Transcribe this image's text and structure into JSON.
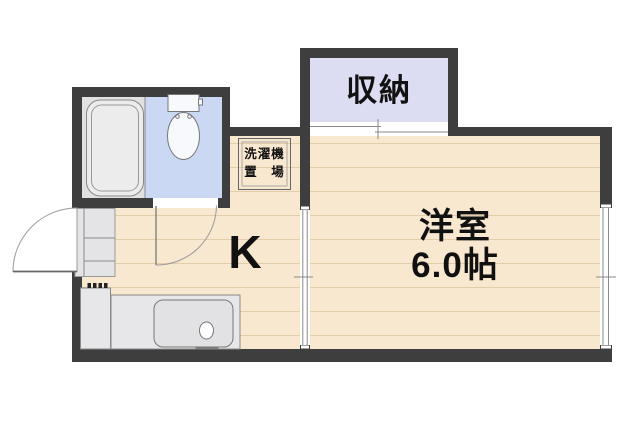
{
  "plan": {
    "rooms": {
      "closet": {
        "label": "収納"
      },
      "western_room": {
        "label": "洋室",
        "size": "6.0帖"
      },
      "kitchen": {
        "label": "K"
      },
      "laundry_space": {
        "label_line1": "洗濯機",
        "label_line2": "置　場"
      }
    },
    "fixtures": [
      "bathtub",
      "toilet",
      "kitchen-sink",
      "gas-stove",
      "entrance-step",
      "entrance-door",
      "bathroom-door",
      "sliding-door",
      "window",
      "closet-sliding-door",
      "washing-machine-space"
    ],
    "colors": {
      "wall": "#3e3e3e",
      "floor": "#f9e8d0",
      "floor_line": "#e3cdab",
      "closet": "#dcdcf2",
      "toilet": "#cad8f3",
      "bath": "#e1e1e1",
      "fixture": "#e7e7e9"
    }
  }
}
